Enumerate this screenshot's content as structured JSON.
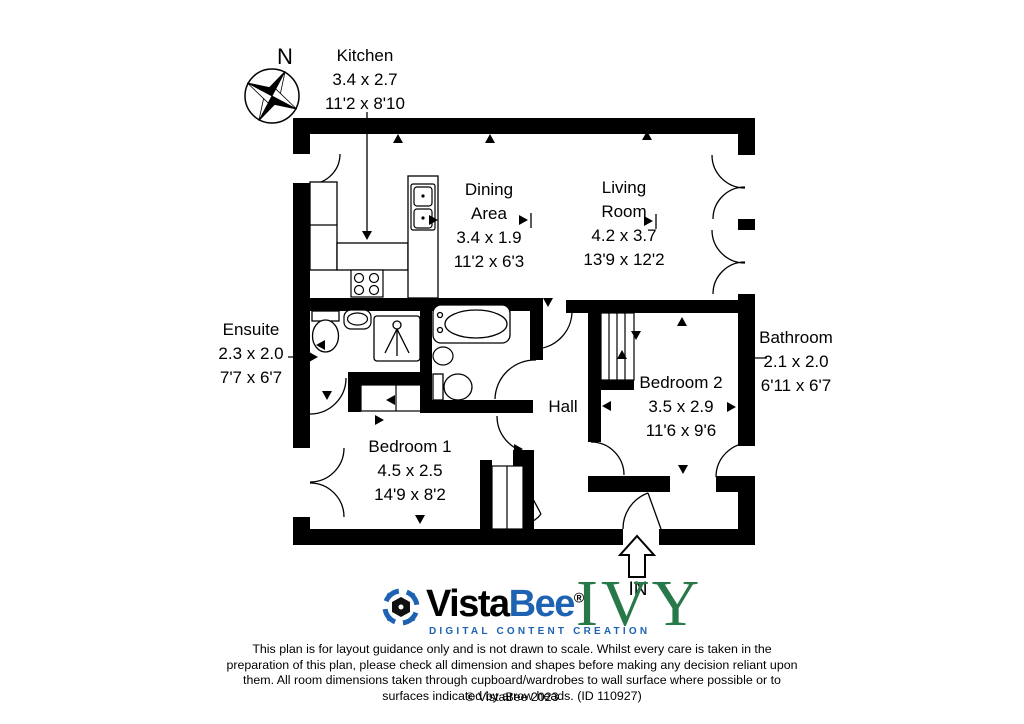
{
  "rooms": {
    "kitchen": {
      "name": "Kitchen",
      "metric": "3.4 x 2.7",
      "imperial": "11'2 x 8'10"
    },
    "dining": {
      "name_line1": "Dining",
      "name_line2": "Area",
      "metric": "3.4 x 1.9",
      "imperial": "11'2 x 6'3"
    },
    "living": {
      "name_line1": "Living",
      "name_line2": "Room",
      "metric": "4.2 x 3.7",
      "imperial": "13'9 x 12'2"
    },
    "ensuite": {
      "name": "Ensuite",
      "metric": "2.3 x 2.0",
      "imperial": "7'7 x 6'7"
    },
    "bathroom": {
      "name": "Bathroom",
      "metric": "2.1 x 2.0",
      "imperial": "6'11 x 6'7"
    },
    "hall": {
      "name": "Hall"
    },
    "bedroom1": {
      "name": "Bedroom 1",
      "metric": "4.5 x 2.5",
      "imperial": "14'9 x 8'2"
    },
    "bedroom2": {
      "name": "Bedroom 2",
      "metric": "3.5 x 2.9",
      "imperial": "11'6 x 9'6"
    }
  },
  "compass": {
    "north_label": "N"
  },
  "entrance": {
    "label": "IN"
  },
  "branding": {
    "vistabee": {
      "name_part1": "Vista",
      "name_part2": "Bee",
      "registered": "®",
      "tagline": "DIGITAL CONTENT CREATION"
    },
    "partner_logo": "IVY"
  },
  "footer": {
    "disclaimer": "This plan is for layout guidance only and is not drawn to scale. Whilst every care is taken in the preparation of this plan, please check all dimension and shapes before making any decision reliant upon them. All room dimensions taken through cupboard/wardrobes to wall surface where possible or to surfaces indicated by arrow heads. (ID 110927)",
    "copyright": "© VistaBee 2023"
  },
  "colors": {
    "wall": "#000000",
    "brand_blue": "#1d63b2",
    "ivy_green": "#27794a"
  }
}
